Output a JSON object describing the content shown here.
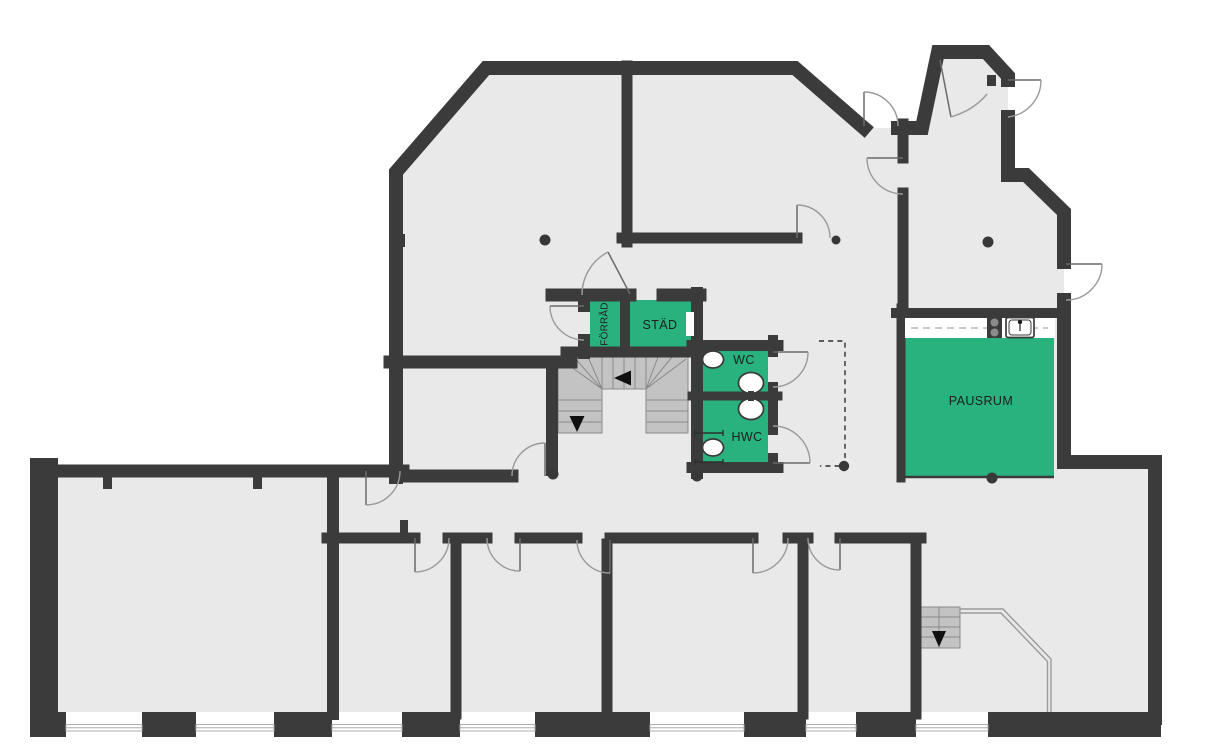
{
  "colors": {
    "wall": "#3b3b3b",
    "floor": "#e9e9e9",
    "highlight_room": "#29b27d",
    "stair_fill": "#c3c3c3",
    "stair_line": "#8a8a8a",
    "detail_line": "#9a9a9a",
    "label_text": "#1e1e1e"
  },
  "rooms": {
    "forrad": {
      "label": "FÖRRÅD",
      "highlighted": true
    },
    "stad": {
      "label": "STÄD",
      "highlighted": true
    },
    "wc": {
      "label": "WC",
      "highlighted": true
    },
    "hwc": {
      "label": "HWC",
      "highlighted": true
    },
    "pausrum": {
      "label": "PAUSRUM",
      "highlighted": true
    }
  }
}
